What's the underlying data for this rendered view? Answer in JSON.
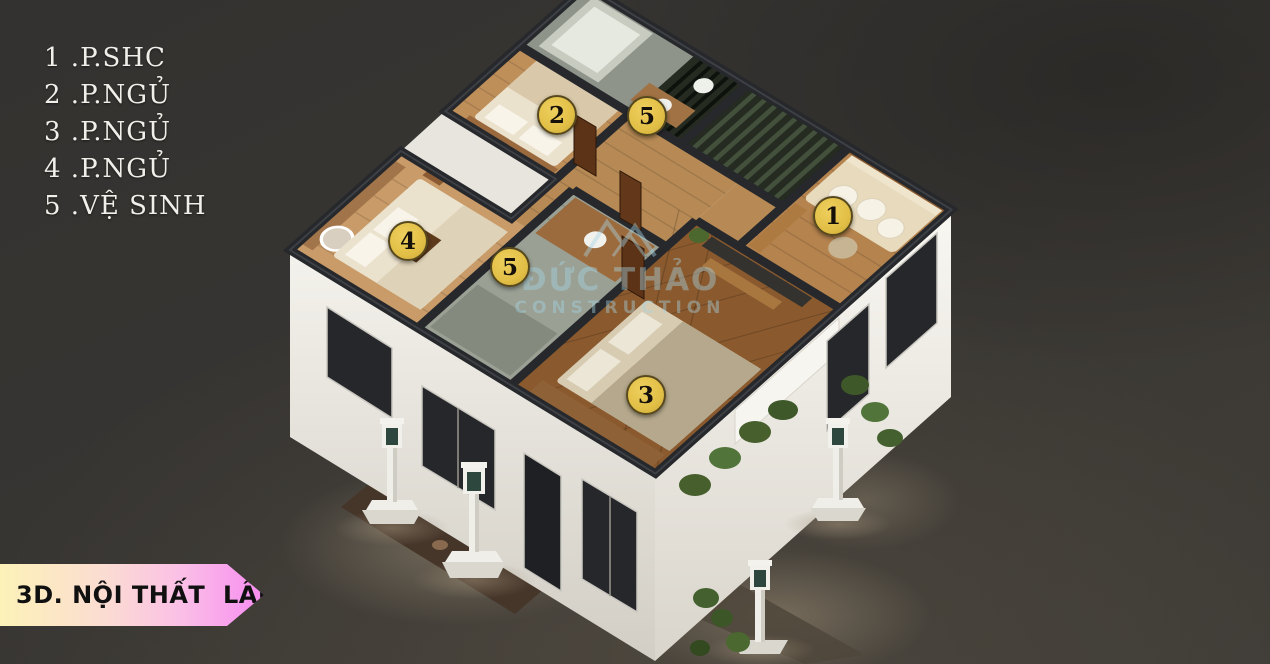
{
  "legend": {
    "items": [
      "1 .P.SHC",
      "2 .P.NGỦ",
      "3 .P.NGỦ",
      "4 .P.NGỦ",
      "5 .VỆ SINH"
    ]
  },
  "markers": [
    {
      "number": "2"
    },
    {
      "number": "5"
    },
    {
      "number": "1"
    },
    {
      "number": "4"
    },
    {
      "number": "5"
    },
    {
      "number": "3"
    }
  ],
  "watermark": {
    "name": "ĐỨC THẢO",
    "subtitle": "CONSTRUCTION"
  },
  "banner": {
    "label": "3D. NỘI THẤT  LẦU 1"
  },
  "colors": {
    "marker_yellow": "#e2bf46",
    "banner_gradient_start": "#fcf2b8",
    "banner_gradient_end": "#f78cf0",
    "watermark_blue": "#a7d6e6",
    "background": "#383633",
    "wall_cap": "#26282c"
  }
}
